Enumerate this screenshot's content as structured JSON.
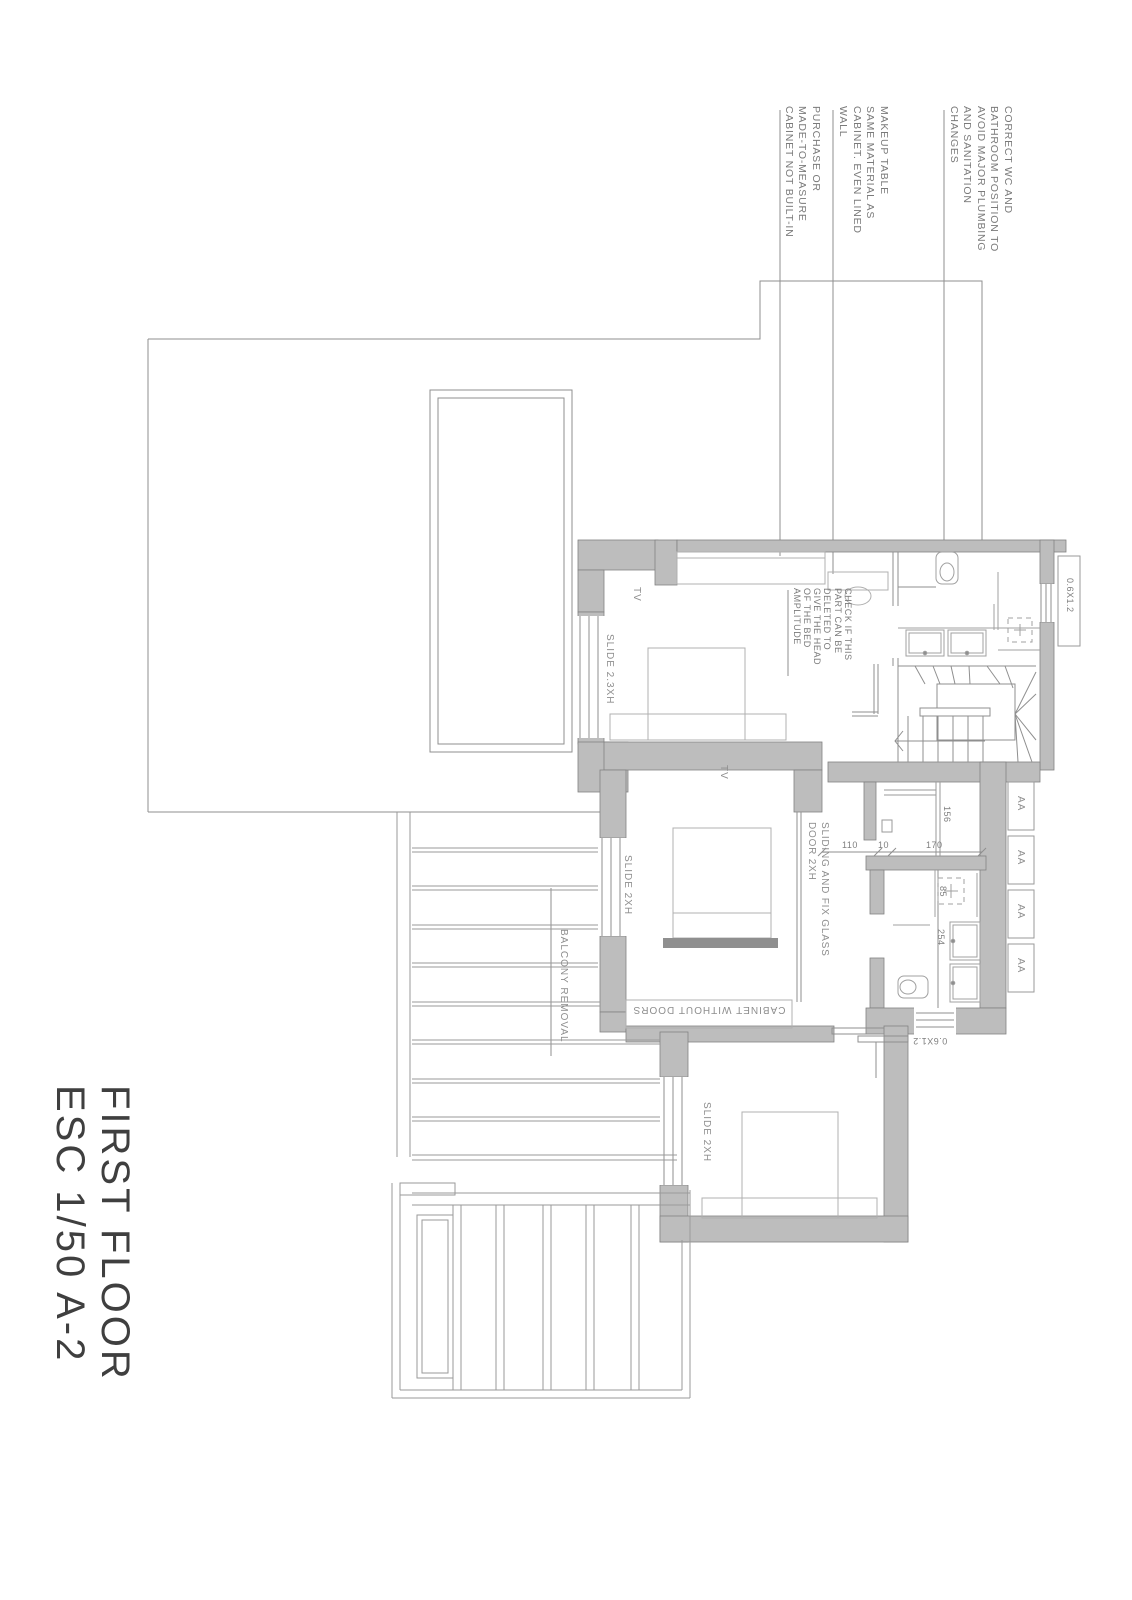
{
  "sheet": {
    "title_lines": [
      "FIRST FLOOR",
      "ESC 1/50 A-2"
    ]
  },
  "colors": {
    "wall_fill": "#bdbdbd",
    "wall_edge": "#828282",
    "thin_line": "#919191",
    "fixture_line": "#a9a9a9",
    "annotation_text": "#7a7a7a",
    "label_text": "#8e8e8e",
    "title_text": "#3f3f3f"
  },
  "annotations": {
    "purchase_cabinet": {
      "lines": [
        "PURCHASE OR",
        "MADE-TO-MEASURE",
        "CABINET NOT BUILT-IN"
      ]
    },
    "makeup_table": {
      "lines": [
        "MAKEUP TABLE",
        "SAME MATERIAL AS",
        "CABINET. EVEN LINED",
        "WALL"
      ]
    },
    "wc_position": {
      "lines": [
        "CORRECT WC AND",
        "BATHROOM POSITION TO",
        "AVOID MAJOR PLUMBING",
        "AND SANITATION",
        "CHANGES"
      ]
    },
    "bed_head_check": {
      "lines": [
        "CHECK IF THIS",
        "PART CAN BE",
        "DELETED TO",
        "GIVE THE HEAD",
        "OF THE BED",
        "AMPLITUDE"
      ]
    },
    "sliding_glass_door": {
      "lines": [
        "SLIDING AND FIX GLASS",
        "DOOR 2XH"
      ]
    },
    "balcony_note": "BALCONY REMOVAL",
    "cabinet_no_doors": "CABINET WITHOUT DOORS"
  },
  "labels": {
    "bedroom1_window": "SLIDE 2.3XH",
    "bedroom2_window": "SLIDE 2XH",
    "bedroom3_window": "SLIDE 2XH",
    "tv_bedroom1": "TV",
    "tv_bedroom2": "TV",
    "small_window_top": "0.6X1.2",
    "small_window_bottom": "0.6X1.2"
  },
  "dimensions": {
    "hall_a": "110",
    "hall_b": "10",
    "closet_width": "170",
    "closet_depth": "156",
    "shower": "85",
    "bathroom_length": "254"
  },
  "wardrobe_modules": [
    "AA",
    "AA",
    "AA",
    "AA"
  ]
}
